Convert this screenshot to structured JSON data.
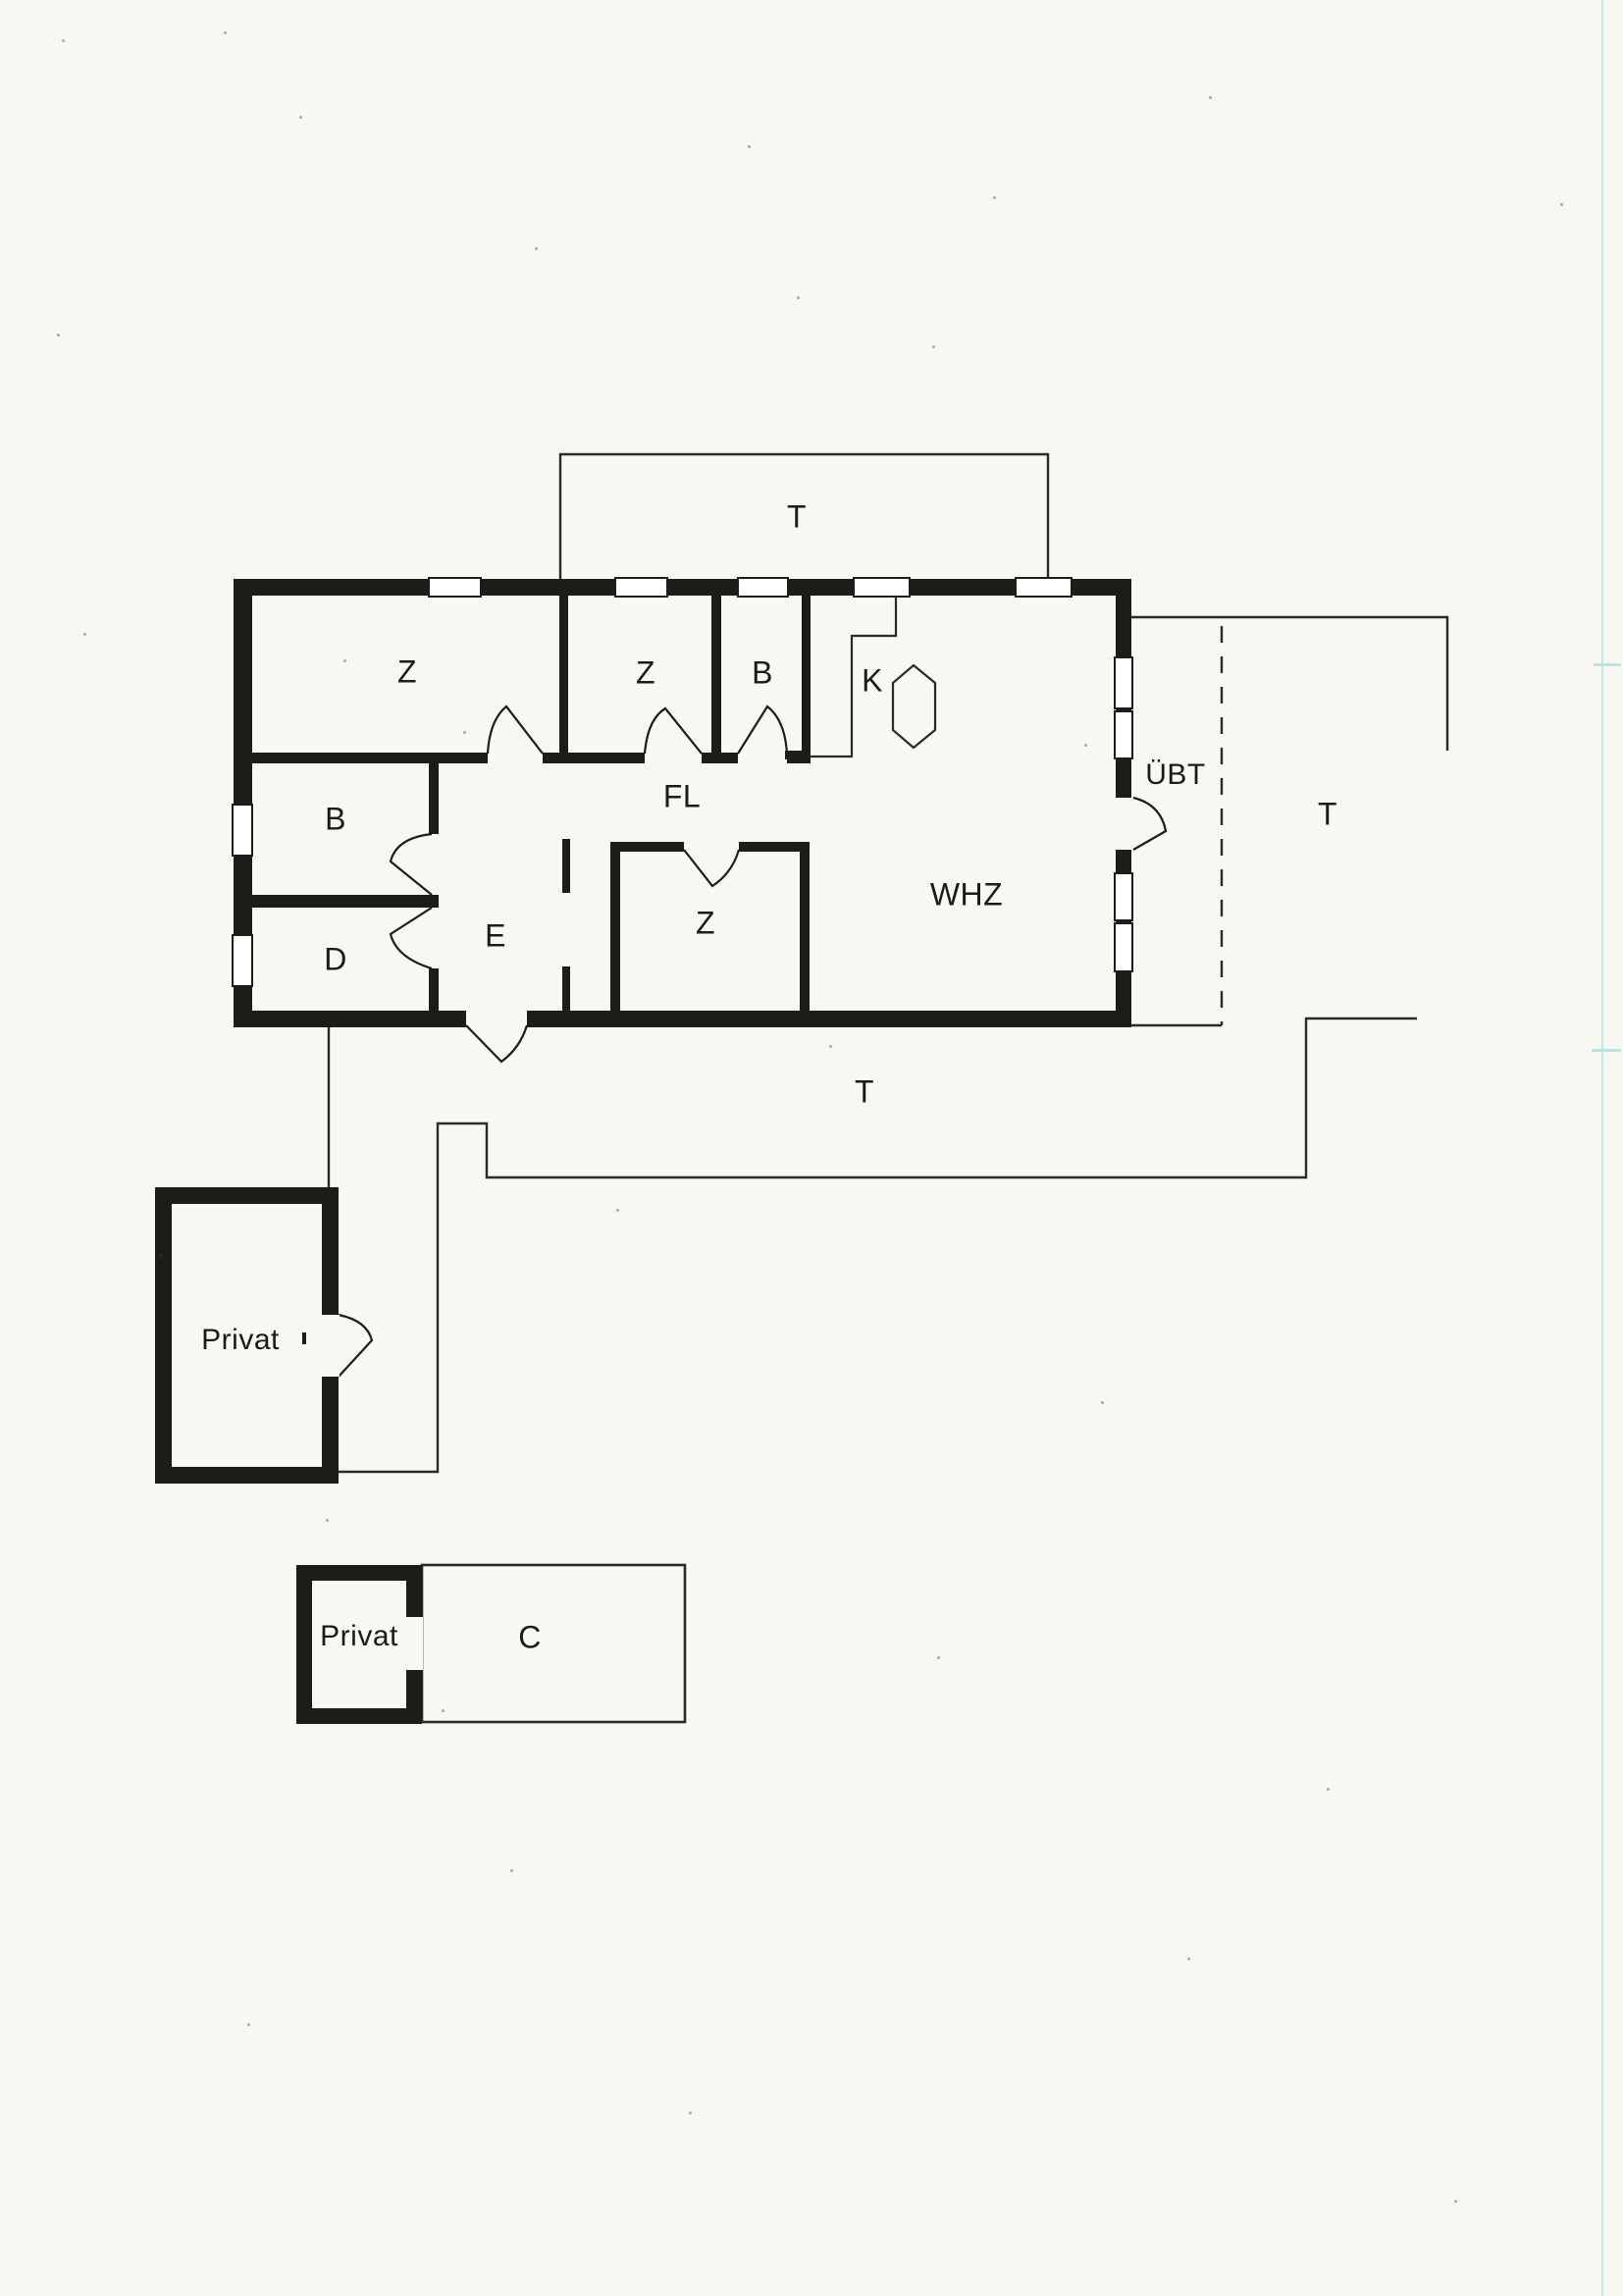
{
  "document": {
    "type": "scanned-floor-plan",
    "background": "#f8f7f2"
  },
  "colors": {
    "wall": "#1d1c19",
    "thin_line": "#2b2a28",
    "window_fill": "#ffffff",
    "scan_artifact_cyan": "#b9e4e2"
  },
  "labels": {
    "terrace_top": "T",
    "room_z1": "Z",
    "room_z2": "Z",
    "room_bath_top": "B",
    "room_kitchen": "K",
    "door_uebt": "ÜBT",
    "terrace_east": "T",
    "room_bath_left": "B",
    "hall_fl": "FL",
    "room_d": "D",
    "entry_e": "E",
    "room_z3": "Z",
    "room_whz": "WHZ",
    "terrace_south": "T",
    "outbuilding_left": "Privat",
    "outbuilding_lower": "Privat",
    "carport_c": "C"
  }
}
